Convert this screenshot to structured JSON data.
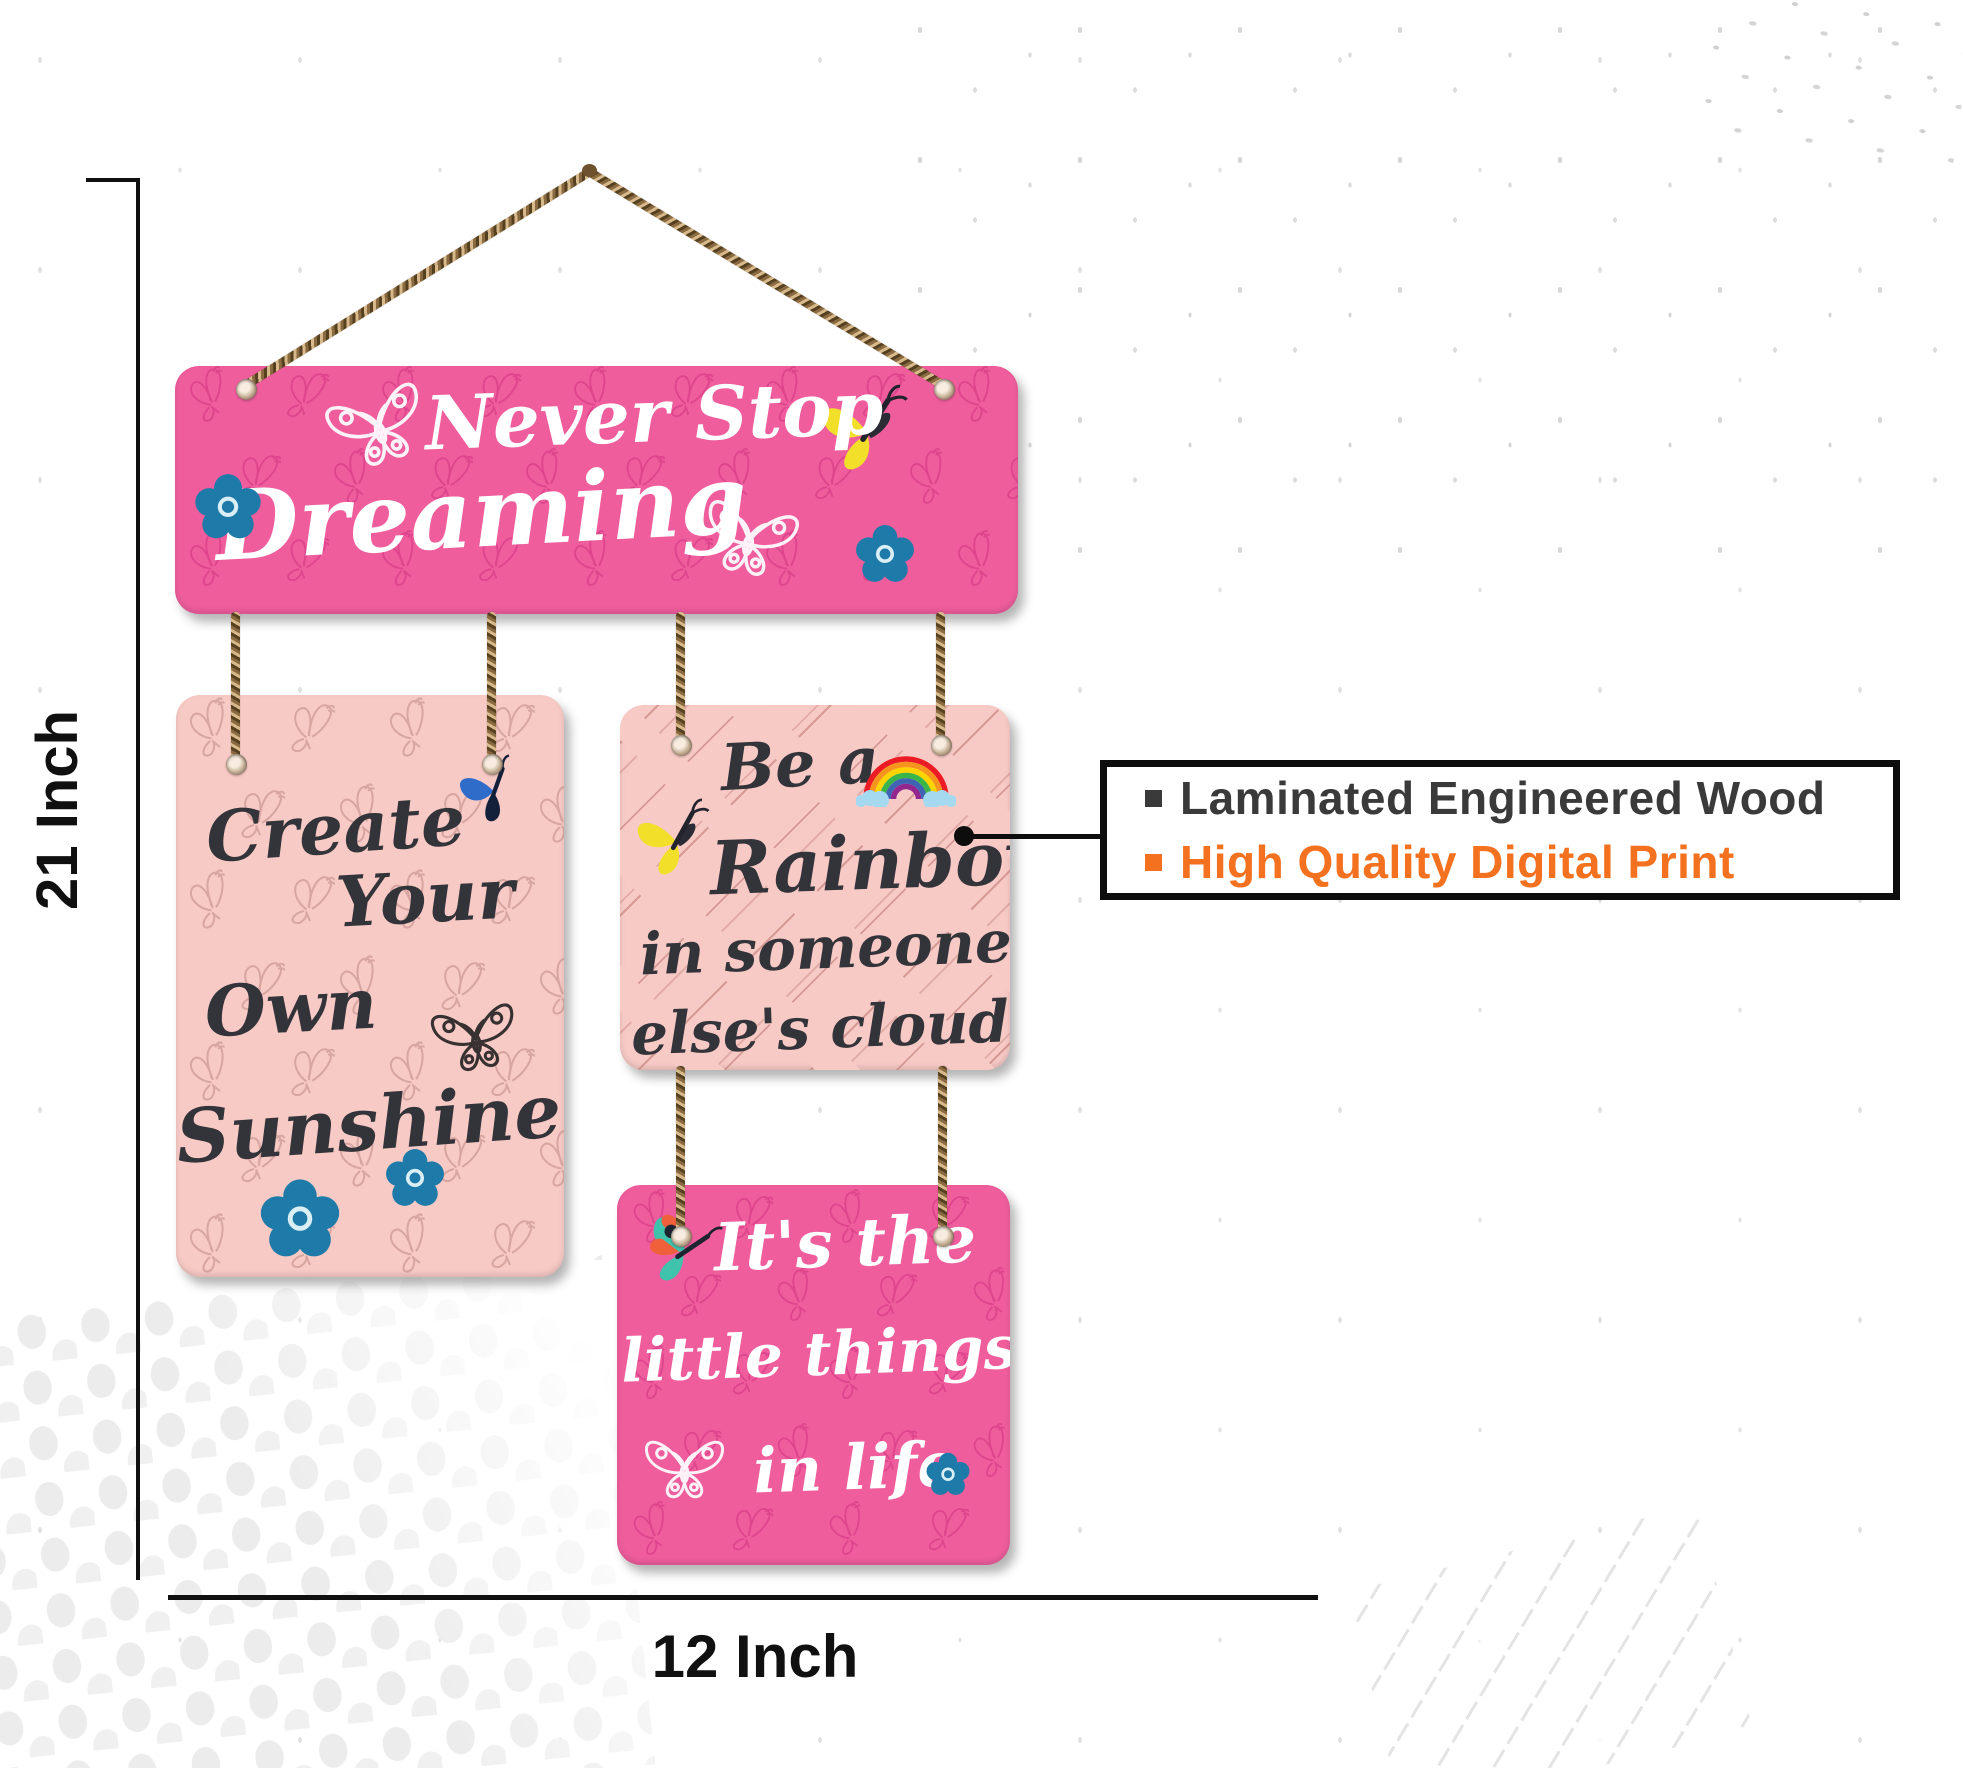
{
  "product": {
    "boards": {
      "top": {
        "bg": "#ef5d9d",
        "lines": [
          "Never Stop",
          "Dreaming"
        ]
      },
      "left": {
        "bg": "#f8cac6",
        "lines": [
          "Create",
          "Your",
          "Own",
          "Sunshine"
        ]
      },
      "right": {
        "bg": "#f8cac6",
        "lines": [
          "Be a",
          "Rainbow",
          "in someone",
          "else's cloud"
        ]
      },
      "bottom": {
        "bg": "#ef5d9d",
        "lines": [
          "It's the",
          "little things",
          "in life"
        ]
      }
    },
    "accent_colors": {
      "board_pink": "#ef5d9d",
      "board_rose": "#f8cac6",
      "flower_blue": "#1e7ba9",
      "butterfly_yellow": "#f2df2a",
      "butterfly_teal": "#3fc3ad",
      "butterfly_orange": "#f0603a",
      "butterfly_blue": "#2f6bc9",
      "rope_brown": "#8a6a40"
    }
  },
  "dimensions": {
    "height_label": "21 Inch",
    "width_label": "12 Inch"
  },
  "callout": {
    "items": [
      {
        "label": "Laminated Engineered Wood",
        "color": "#3a3a3a"
      },
      {
        "label": "High Quality Digital Print",
        "color": "#f4711f"
      }
    ]
  }
}
